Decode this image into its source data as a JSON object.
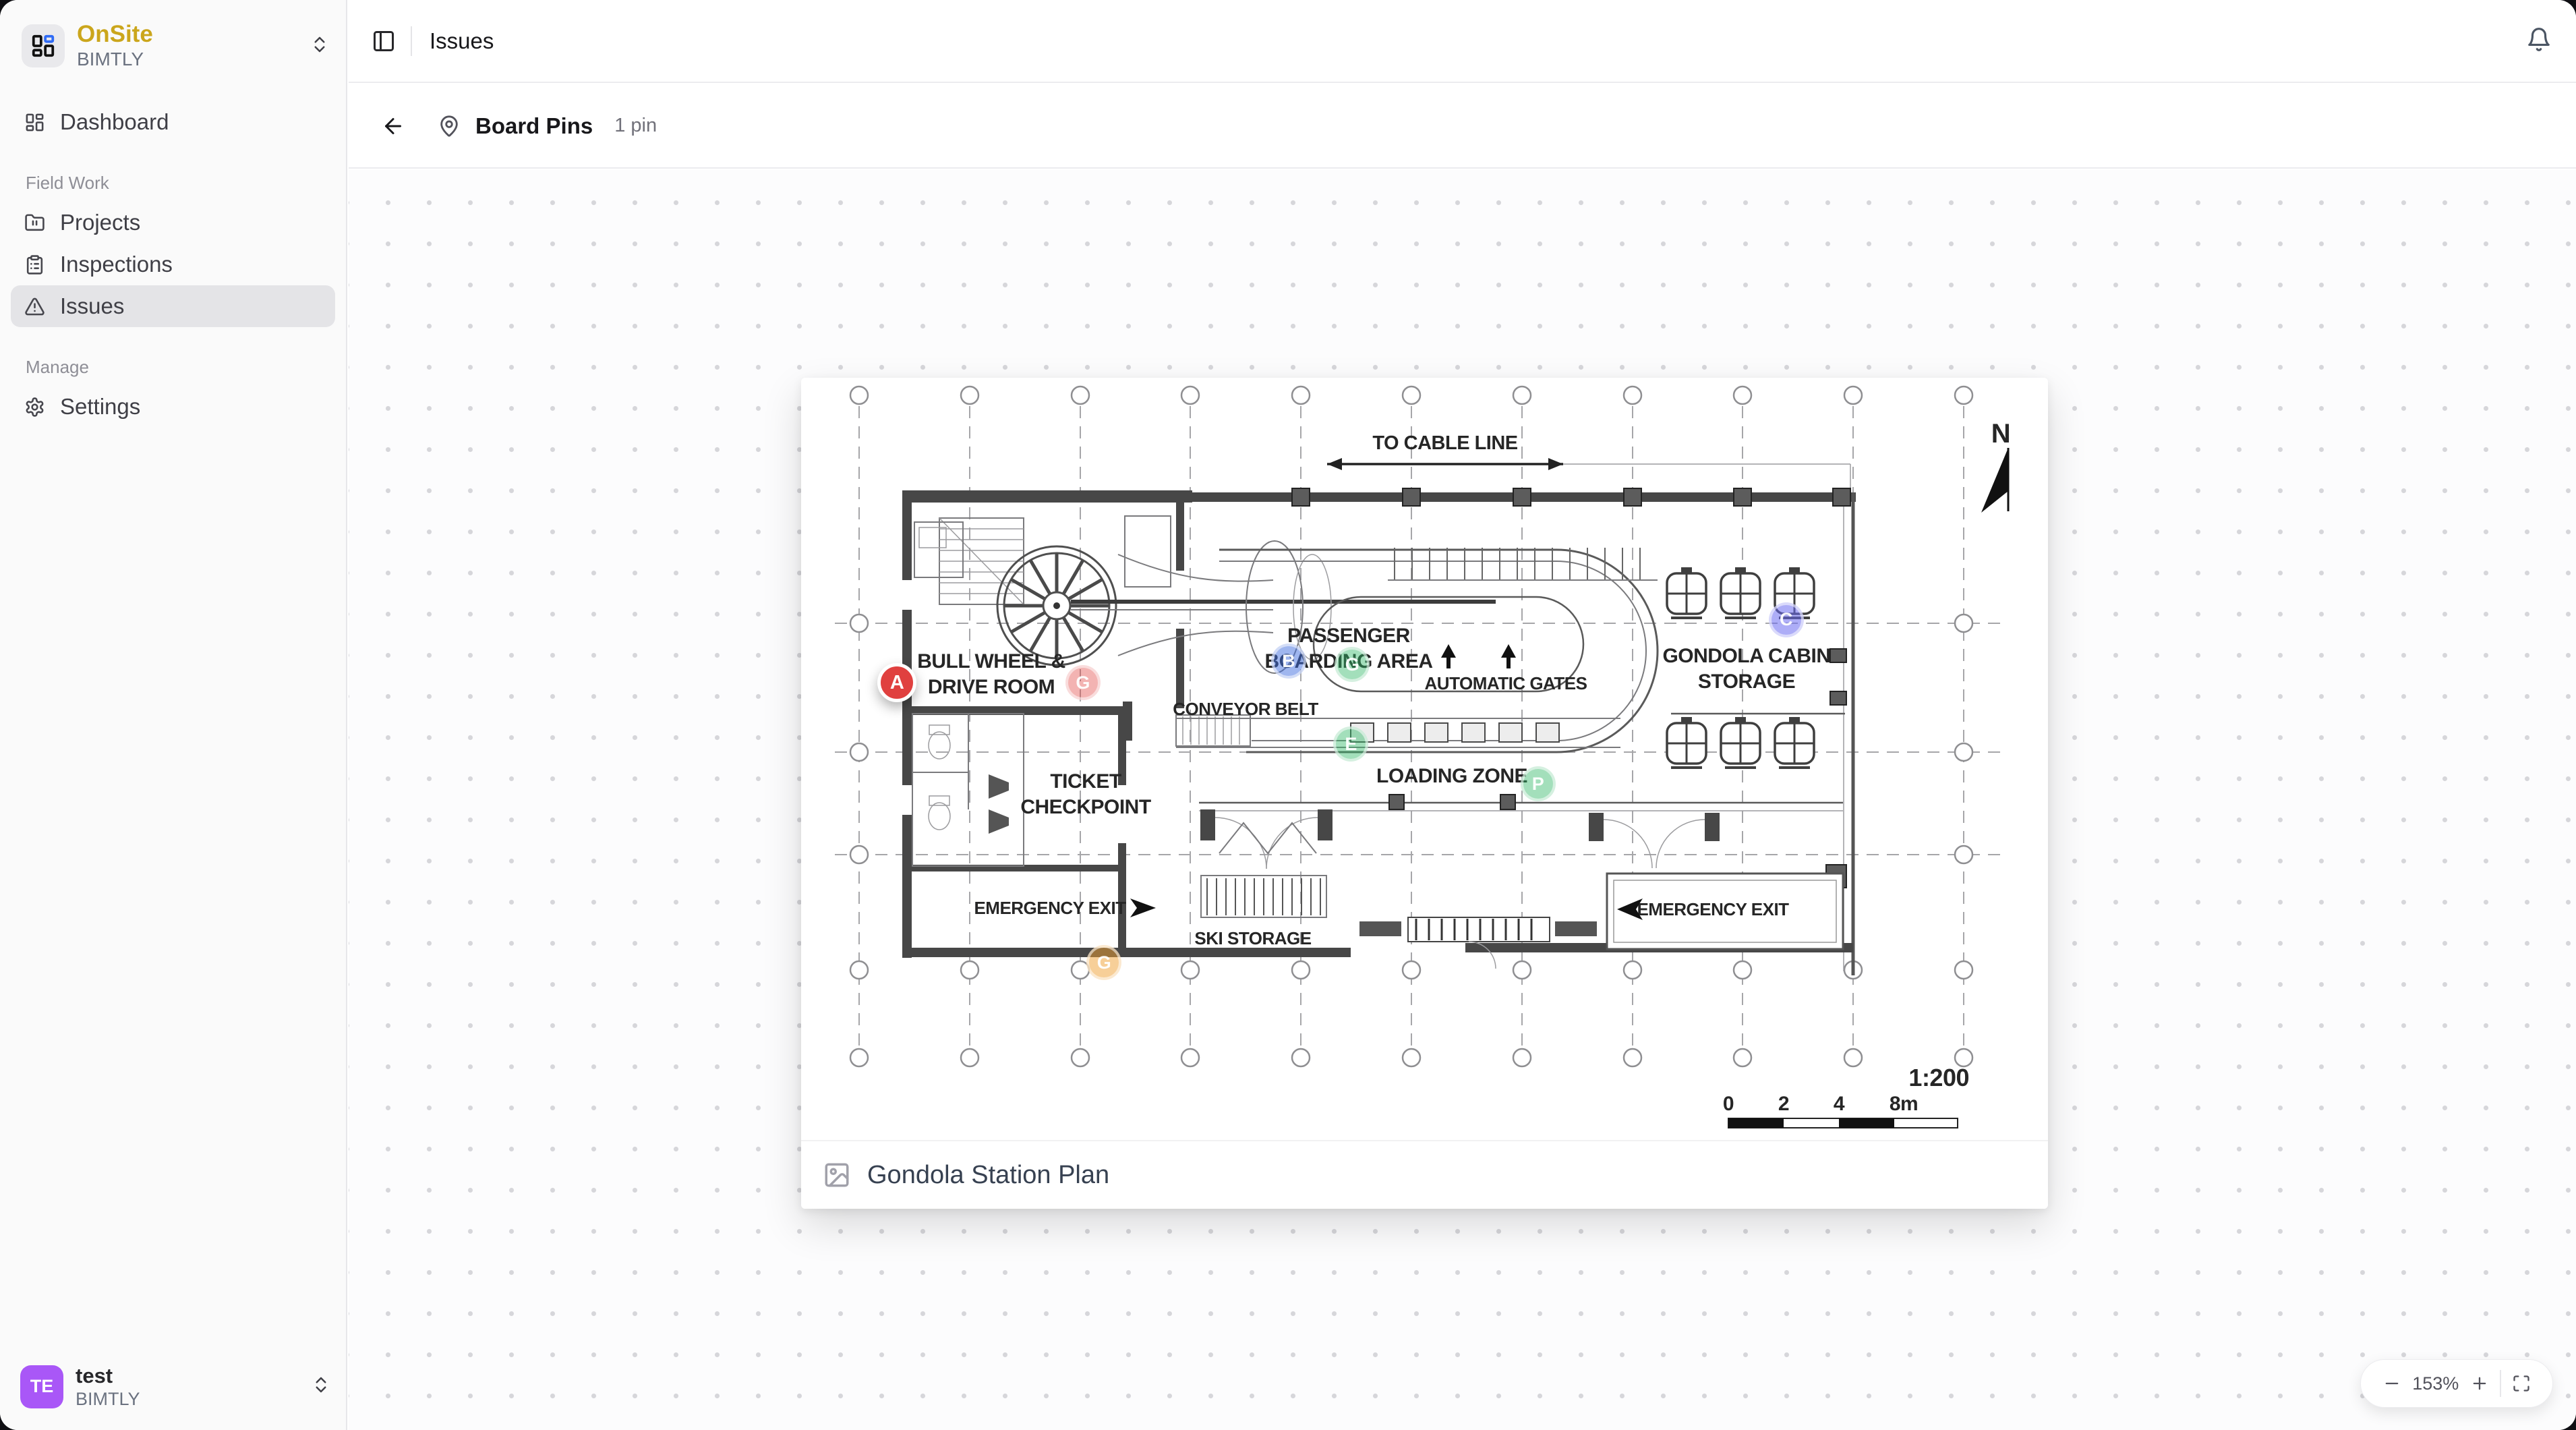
{
  "app": {
    "name": "OnSite",
    "org": "BIMTLY"
  },
  "topbar": {
    "title": "Issues"
  },
  "board": {
    "title": "Board Pins",
    "count": "1 pin"
  },
  "sidebar": {
    "dashboard": {
      "label": "Dashboard"
    },
    "sections": [
      {
        "label": "Field Work",
        "items": [
          {
            "label": "Projects"
          },
          {
            "label": "Inspections"
          },
          {
            "label": "Issues",
            "active": true
          }
        ]
      },
      {
        "label": "Manage",
        "items": [
          {
            "label": "Settings"
          }
        ]
      }
    ],
    "user": {
      "initials": "TE",
      "name": "test",
      "org": "BIMTLY"
    }
  },
  "viewer": {
    "zoom": "153%"
  },
  "plan": {
    "caption": "Gondola Station Plan",
    "north": "N",
    "scale": "1:200",
    "scale_ticks": {
      "t0": "0",
      "t1": "2",
      "t2": "4",
      "t3": "8m"
    },
    "labels": {
      "to_cable_line": "TO CABLE LINE",
      "bull_wheel_1": "BULL WHEEL &",
      "bull_wheel_2": "DRIVE ROOM",
      "passenger_1": "PASSENGER",
      "passenger_2": "BOARDING AREA",
      "automatic_gates": "AUTOMATIC GATES",
      "conveyor_belt": "CONVEYOR BELT",
      "storage_1": "GONDOLA CABIN",
      "storage_2": "STORAGE",
      "ticket_1": "TICKET",
      "ticket_2": "CHECKPOINT",
      "loading_zone": "LOADING ZONE",
      "emergency_exit_left": "EMERGENCY EXIT",
      "ski_storage": "SKI STORAGE",
      "emergency_exit_right": "EMERGENCY EXIT"
    },
    "pins": [
      {
        "letter": "A",
        "x_pct": 7.7,
        "y_pct": 36.7,
        "bg": "#e0403f",
        "solid": true
      },
      {
        "letter": "G",
        "x_pct": 22.6,
        "y_pct": 36.7,
        "bg": "rgba(224,64,63,0.40)",
        "solid": false
      },
      {
        "letter": "B",
        "x_pct": 39.1,
        "y_pct": 34.1,
        "bg": "rgba(64,110,224,0.50)",
        "solid": false
      },
      {
        "letter": "G",
        "x_pct": 44.2,
        "y_pct": 34.5,
        "bg": "rgba(52,185,105,0.45)",
        "solid": false
      },
      {
        "letter": "E",
        "x_pct": 44.1,
        "y_pct": 44.1,
        "bg": "rgba(52,185,105,0.45)",
        "solid": false
      },
      {
        "letter": "P",
        "x_pct": 59.1,
        "y_pct": 48.9,
        "bg": "rgba(52,185,105,0.45)",
        "solid": false
      },
      {
        "letter": "C",
        "x_pct": 79.0,
        "y_pct": 29.1,
        "bg": "rgba(105,105,240,0.55)",
        "solid": false
      },
      {
        "letter": "G",
        "x_pct": 24.3,
        "y_pct": 70.4,
        "bg": "rgba(240,160,50,0.50)",
        "solid": false
      }
    ]
  },
  "colors": {
    "brand_gold": "#cba61c",
    "logo_blue": "#2f6bf6",
    "avatar_purple": "#a957f7",
    "pin_red": "#e0403f",
    "active_item_bg": "#e4e4e7"
  }
}
